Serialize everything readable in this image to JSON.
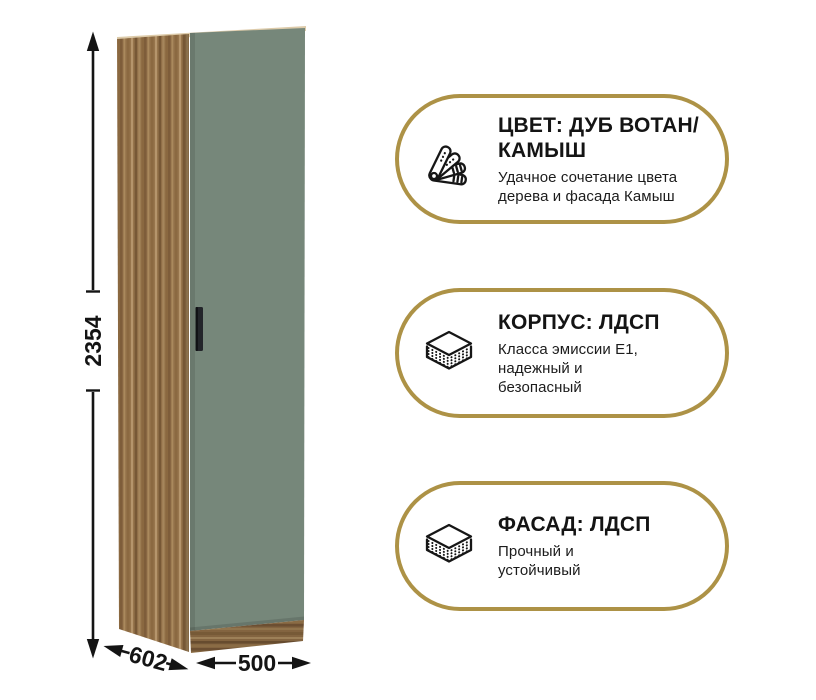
{
  "canvas": {
    "background": "#ffffff"
  },
  "wardrobe": {
    "description": "single-door wardrobe, oak body with green facade",
    "dimensions": {
      "height_mm": "2354",
      "depth_mm": "602",
      "width_mm": "500"
    },
    "colors": {
      "body_wood": "#97754c",
      "door_facade": "#76877a",
      "top_edge": "#ddcbaa",
      "handle": "#23252a",
      "dimension_lines": "#141414"
    }
  },
  "accent": {
    "badge_border": "#ad9246"
  },
  "badges": [
    {
      "id": "color",
      "icon": "color-swatch-fan-icon",
      "title_lines": [
        "ЦВЕТ: ДУБ ВОТАН/",
        "КАМЫШ"
      ],
      "subtitle_lines": [
        "Удачное сочетание цвета",
        "дерева и фасада Камыш"
      ]
    },
    {
      "id": "body",
      "icon": "layered-board-icon",
      "title_lines": [
        "КОРПУС: ЛДСП"
      ],
      "subtitle_lines": [
        "Класса эмиссии Е1,",
        "надежный и",
        "безопасный"
      ]
    },
    {
      "id": "facade",
      "icon": "layered-board-icon",
      "title_lines": [
        "ФАСАД: ЛДСП"
      ],
      "subtitle_lines": [
        "Прочный и",
        "устойчивый"
      ]
    }
  ]
}
